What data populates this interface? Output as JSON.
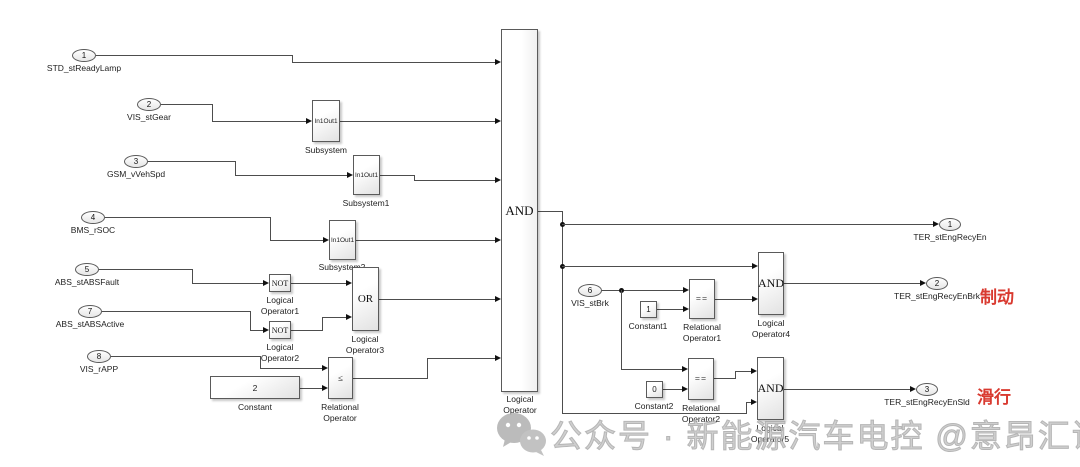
{
  "inputs": [
    {
      "num": "1",
      "label": "STD_stReadyLamp"
    },
    {
      "num": "2",
      "label": "VIS_stGear"
    },
    {
      "num": "3",
      "label": "GSM_vVehSpd"
    },
    {
      "num": "4",
      "label": "BMS_rSOC"
    },
    {
      "num": "5",
      "label": "ABS_stABSFault"
    },
    {
      "num": "7",
      "label": "ABS_stABSActive"
    },
    {
      "num": "8",
      "label": "VIS_rAPP"
    },
    {
      "num": "6",
      "label": "VIS_stBrk"
    }
  ],
  "outputs": [
    {
      "num": "1",
      "label": "TER_stEngRecyEn"
    },
    {
      "num": "2",
      "label": "TER_stEngRecyEnBrk"
    },
    {
      "num": "3",
      "label": "TER_stEngRecyEnSld"
    }
  ],
  "blocks": {
    "subsystem": {
      "in": "In1",
      "out": "Out1",
      "label": "Subsystem"
    },
    "subsystem1": {
      "in": "In1",
      "out": "Out1",
      "label": "Subsystem1"
    },
    "subsystem2": {
      "in": "In1",
      "out": "Out1",
      "label": "Subsystem2"
    },
    "not1": {
      "op": "NOT",
      "label": "Logical\nOperator1"
    },
    "not2": {
      "op": "NOT",
      "label": "Logical\nOperator2"
    },
    "or": {
      "op": "OR",
      "label": "Logical\nOperator3"
    },
    "constant": {
      "value": "2",
      "label": "Constant"
    },
    "relop": {
      "op": "≤",
      "label": "Relational\nOperator"
    },
    "main_and": {
      "op": "AND",
      "label": "Logical\nOperator"
    },
    "constant1": {
      "value": "1",
      "label": "Constant1"
    },
    "relop1": {
      "op": "==",
      "label": "Relational\nOperator1"
    },
    "and4": {
      "op": "AND",
      "label": "Logical\nOperator4"
    },
    "constant2": {
      "value": "0",
      "label": "Constant2"
    },
    "relop2": {
      "op": "==",
      "label": "Relational\nOperator2"
    },
    "and5": {
      "op": "AND",
      "label": "Logical\nOperator5"
    }
  },
  "annotations": {
    "brake": "制动",
    "slide": "滑行",
    "color": "#d93a30"
  },
  "watermark": {
    "icon": "wechat-icon",
    "text": "公众号 · 新能源汽车电控 @意昂汇课"
  }
}
